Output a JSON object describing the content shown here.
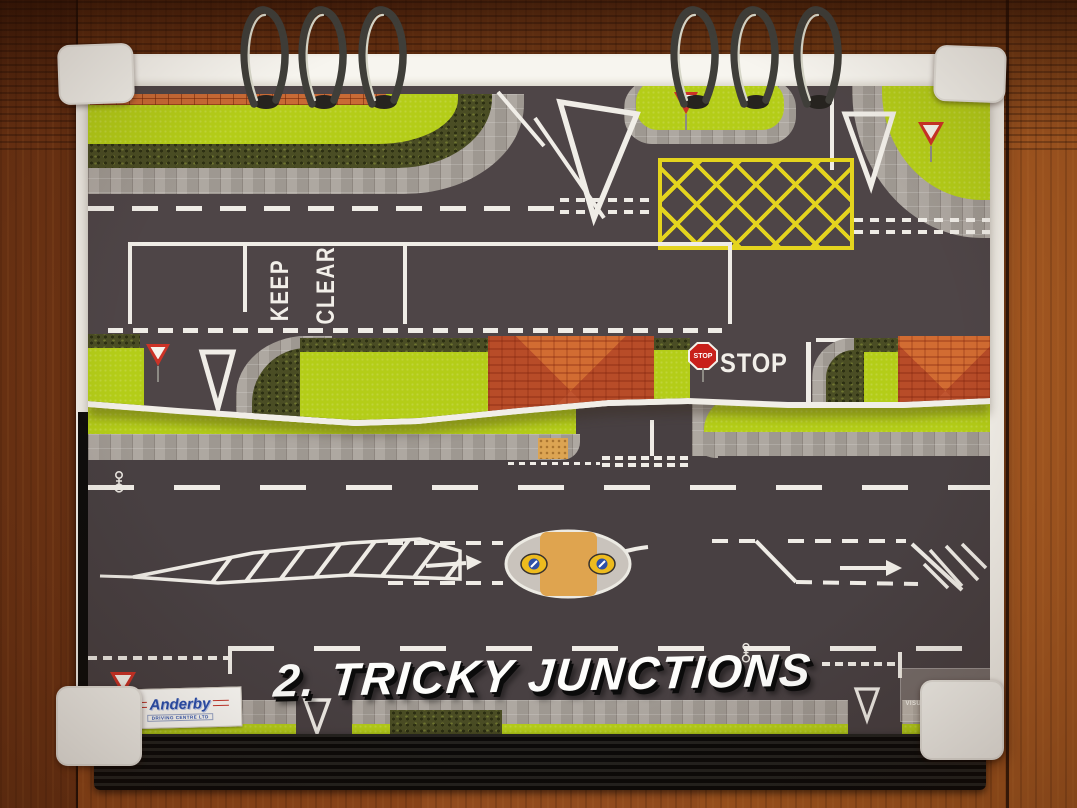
{
  "photo": {
    "title_overlay": "2. TRICKY JUNCTIONS",
    "road_markings": {
      "keep": "KEEP",
      "clear": "CLEAR",
      "stop_road_text": "STOP"
    },
    "signs": {
      "stop": "STOP",
      "give_way": "GIVE WAY"
    },
    "logos": {
      "anderby": {
        "name": "Anderby",
        "subtitle": "DRIVING CENTRE LTD"
      },
      "via": {
        "letter_v": "V",
        "letter_a": "A",
        "caption": "VISUAL INSTRUCTOR AID",
        "copyright": "© Julian Gardner, 2021"
      }
    },
    "colors": {
      "grass": "#b4cd18",
      "asphalt_upper": "#4e4547",
      "asphalt_lower": "#484042",
      "box_junction_yellow": "#e4d41e",
      "stop_sign_red": "#c8201a",
      "give_way_red": "#cc3327",
      "wood_table": "#9c5120",
      "anderby_blue": "#2a4fae",
      "anderby_red": "#c5362c",
      "traffic_light_red": "#d23b2f",
      "traffic_light_amber": "#e8a81f",
      "traffic_light_green": "#7ab648"
    }
  }
}
